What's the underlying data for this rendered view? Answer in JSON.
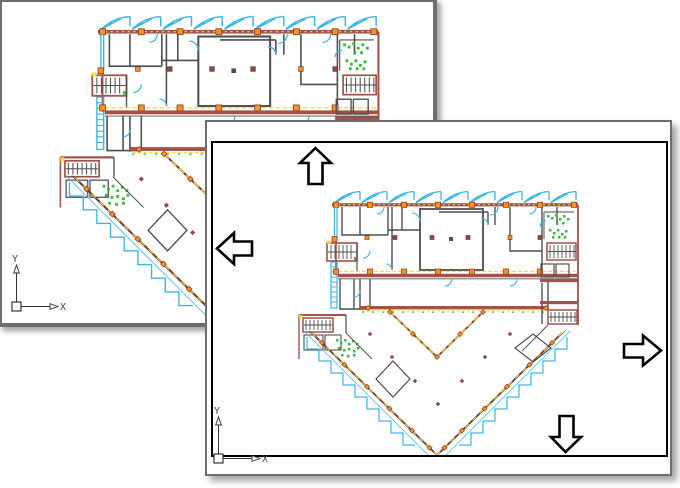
{
  "background_window": {
    "axis": {
      "x_label": "X",
      "y_label": "Y"
    }
  },
  "foreground_window": {
    "axis": {
      "x_label": "X",
      "y_label": "Y"
    },
    "pan_arrows": [
      "up",
      "left",
      "right",
      "down"
    ]
  },
  "colors": {
    "frame_gray": "#6e6e6e",
    "canvas_border": "#000000",
    "wall_gray": "#4f4f4f",
    "wall_red": "#a0524b",
    "edge_brown": "#7a3b2e",
    "accent_cyan": "#38b6e8",
    "accent_yellow": "#efe032",
    "accent_orange": "#f79420",
    "accent_green": "#3cb843",
    "marker_maroon": "#8e4a42",
    "axis_text": "#4a4a4a"
  }
}
